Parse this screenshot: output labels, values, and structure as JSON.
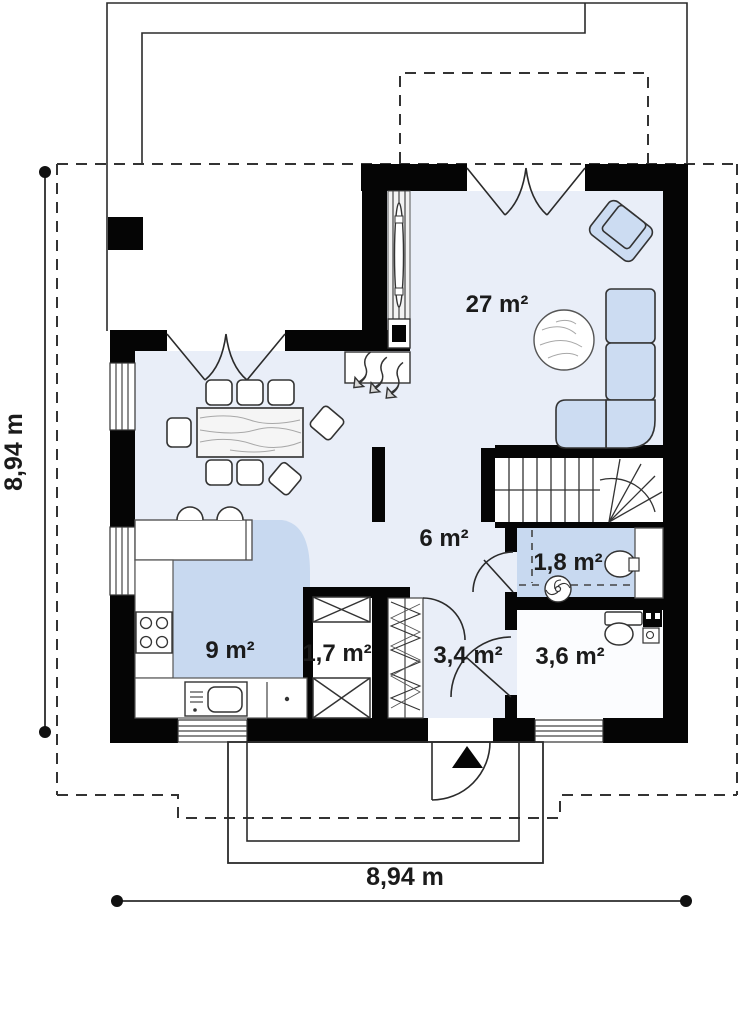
{
  "plan": {
    "room_labels": [
      {
        "id": "living-room",
        "label": "27 m²"
      },
      {
        "id": "hall",
        "label": "6 m²"
      },
      {
        "id": "bathroom-small",
        "label": "1,8 m²"
      },
      {
        "id": "kitchen",
        "label": "9 m²"
      },
      {
        "id": "closet",
        "label": "1,7 m²"
      },
      {
        "id": "entry-hall",
        "label": "3,4 m²"
      },
      {
        "id": "wc",
        "label": "3,6 m²"
      }
    ],
    "dimensions": {
      "left_label": "8,94 m",
      "bottom_label": "8,94 m"
    },
    "symbols": [
      "corner-sofa",
      "armchair",
      "round-rug",
      "dining-table",
      "chairs",
      "bar-stools",
      "kitchen-stove",
      "kitchen-sink",
      "radiator",
      "chimney",
      "fireplace",
      "wardrobe-crossed",
      "coat-rack-hatch",
      "stairs",
      "toilet",
      "washbasin",
      "extractor-fan",
      "entrance-arrow",
      "casement-window",
      "door-swing"
    ],
    "colors": {
      "wall": "#050505",
      "floor": "#e9eef8",
      "accent_floor": "#c8d9f0",
      "furniture": "#ccdcf2",
      "line": "#2b2b2b"
    }
  }
}
